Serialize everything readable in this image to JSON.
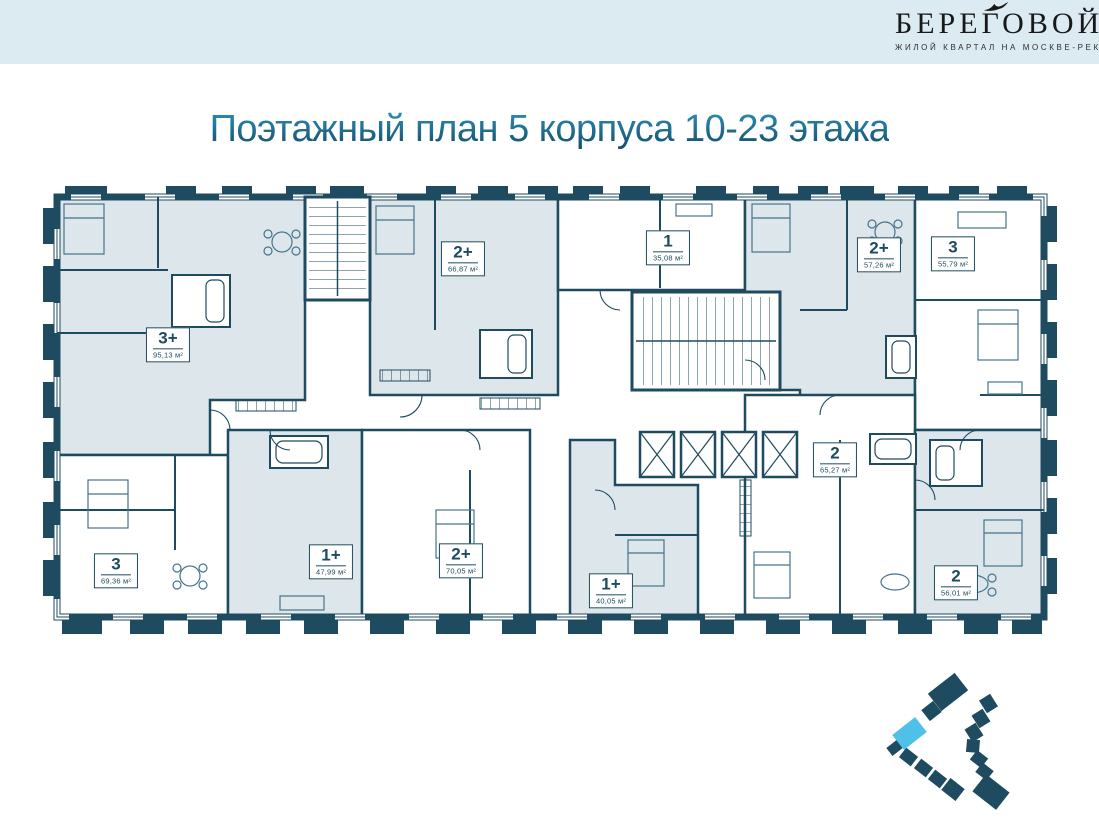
{
  "header": {
    "logo_title": "БЕРЕГОВОЙ",
    "logo_subtitle": "ЖИЛОЙ КВАРТАЛ НА МОСКВЕ-РЕКЕ"
  },
  "title": "Поэтажный план 5 корпуса 10-23 этажа",
  "plan": {
    "apartments": [
      {
        "rooms": "3+",
        "area": "95,13 м²",
        "shaded": true
      },
      {
        "rooms": "2+",
        "area": "66,87 м²",
        "shaded": true
      },
      {
        "rooms": "1",
        "area": "35,08 м²",
        "shaded": false
      },
      {
        "rooms": "2+",
        "area": "57,26 м²",
        "shaded": true
      },
      {
        "rooms": "3",
        "area": "55,79 м²",
        "shaded": false
      },
      {
        "rooms": "3",
        "area": "69,36 м²",
        "shaded": false
      },
      {
        "rooms": "1+",
        "area": "47,99 м²",
        "shaded": true
      },
      {
        "rooms": "2+",
        "area": "70,05 м²",
        "shaded": false
      },
      {
        "rooms": "1+",
        "area": "40,05 м²",
        "shaded": true
      },
      {
        "rooms": "2",
        "area": "65,27 м²",
        "shaded": false
      },
      {
        "rooms": "2",
        "area": "56,01 м²",
        "shaded": true
      }
    ],
    "core": {
      "elevators": 4,
      "stairwells": 2
    }
  },
  "colors": {
    "wall": "#1e4b5f",
    "room_fill": "#dde6eb",
    "header_bg": "#dcebf1",
    "highlight_blue": "#4fc0e8",
    "title_blue": "#1d6f94"
  }
}
